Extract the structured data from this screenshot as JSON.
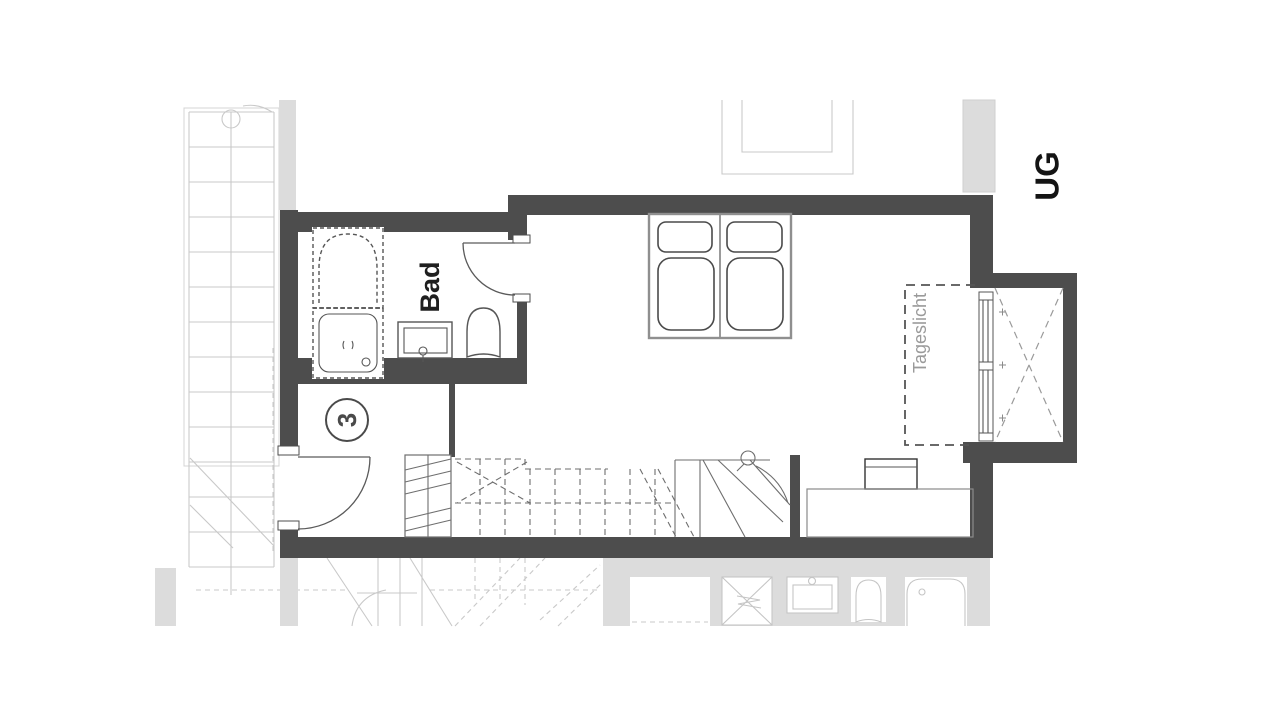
{
  "floorplan": {
    "floor_label": "UG",
    "bathroom_label": "Bad",
    "unit_number": "3",
    "daylight_label": "Tageslicht",
    "colors": {
      "wall": "#4d4d4d",
      "faded-fill": "#dcdcdc",
      "faded-line": "#c9c9c9",
      "fixture-line": "#565656",
      "stair-line": "#6e6e6e",
      "label-dark": "#141414",
      "label-muted": "#9a9a9a"
    }
  }
}
